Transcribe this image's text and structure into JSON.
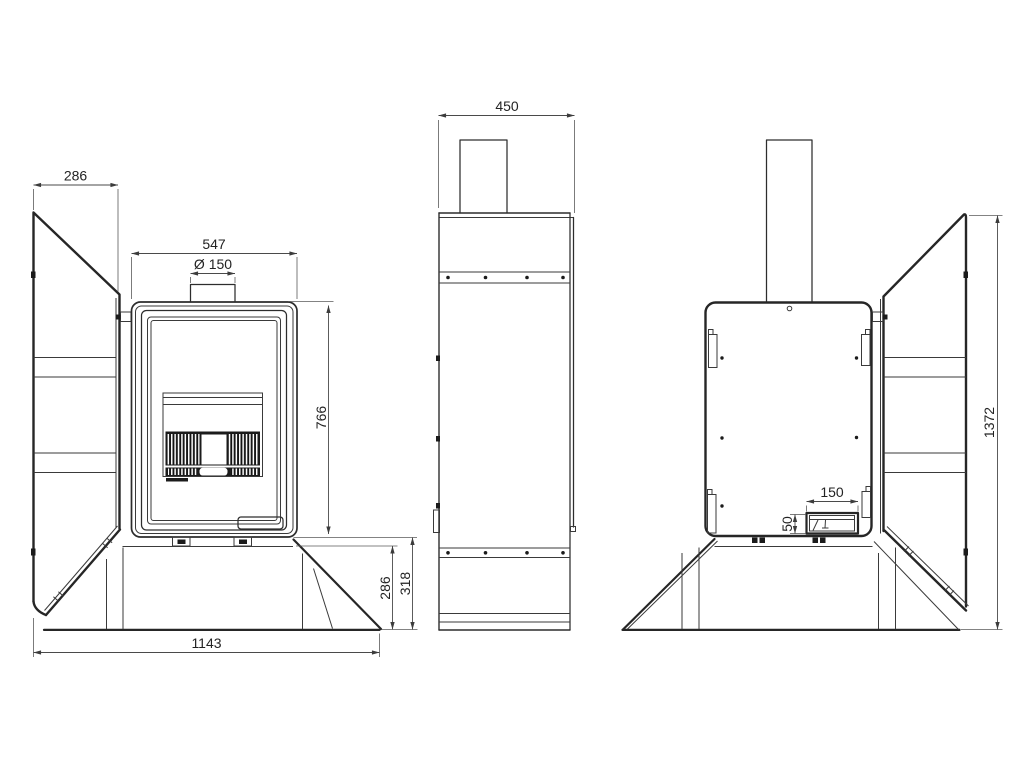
{
  "ink": "#2d2d2d",
  "dimension_color": "#4a4a4a",
  "background": "#ffffff",
  "views": {
    "front": {
      "dims": {
        "side_panel_width": "286",
        "body_width": "547",
        "flue_diameter": "Ø 150",
        "body_height": "766",
        "plinth_height": "286",
        "base_height": "318",
        "overall_width": "1143"
      }
    },
    "side": {
      "dims": {
        "depth": "450"
      }
    },
    "rear": {
      "dims": {
        "outlet_width": "150",
        "outlet_height": "50",
        "overall_height": "1372"
      }
    }
  }
}
